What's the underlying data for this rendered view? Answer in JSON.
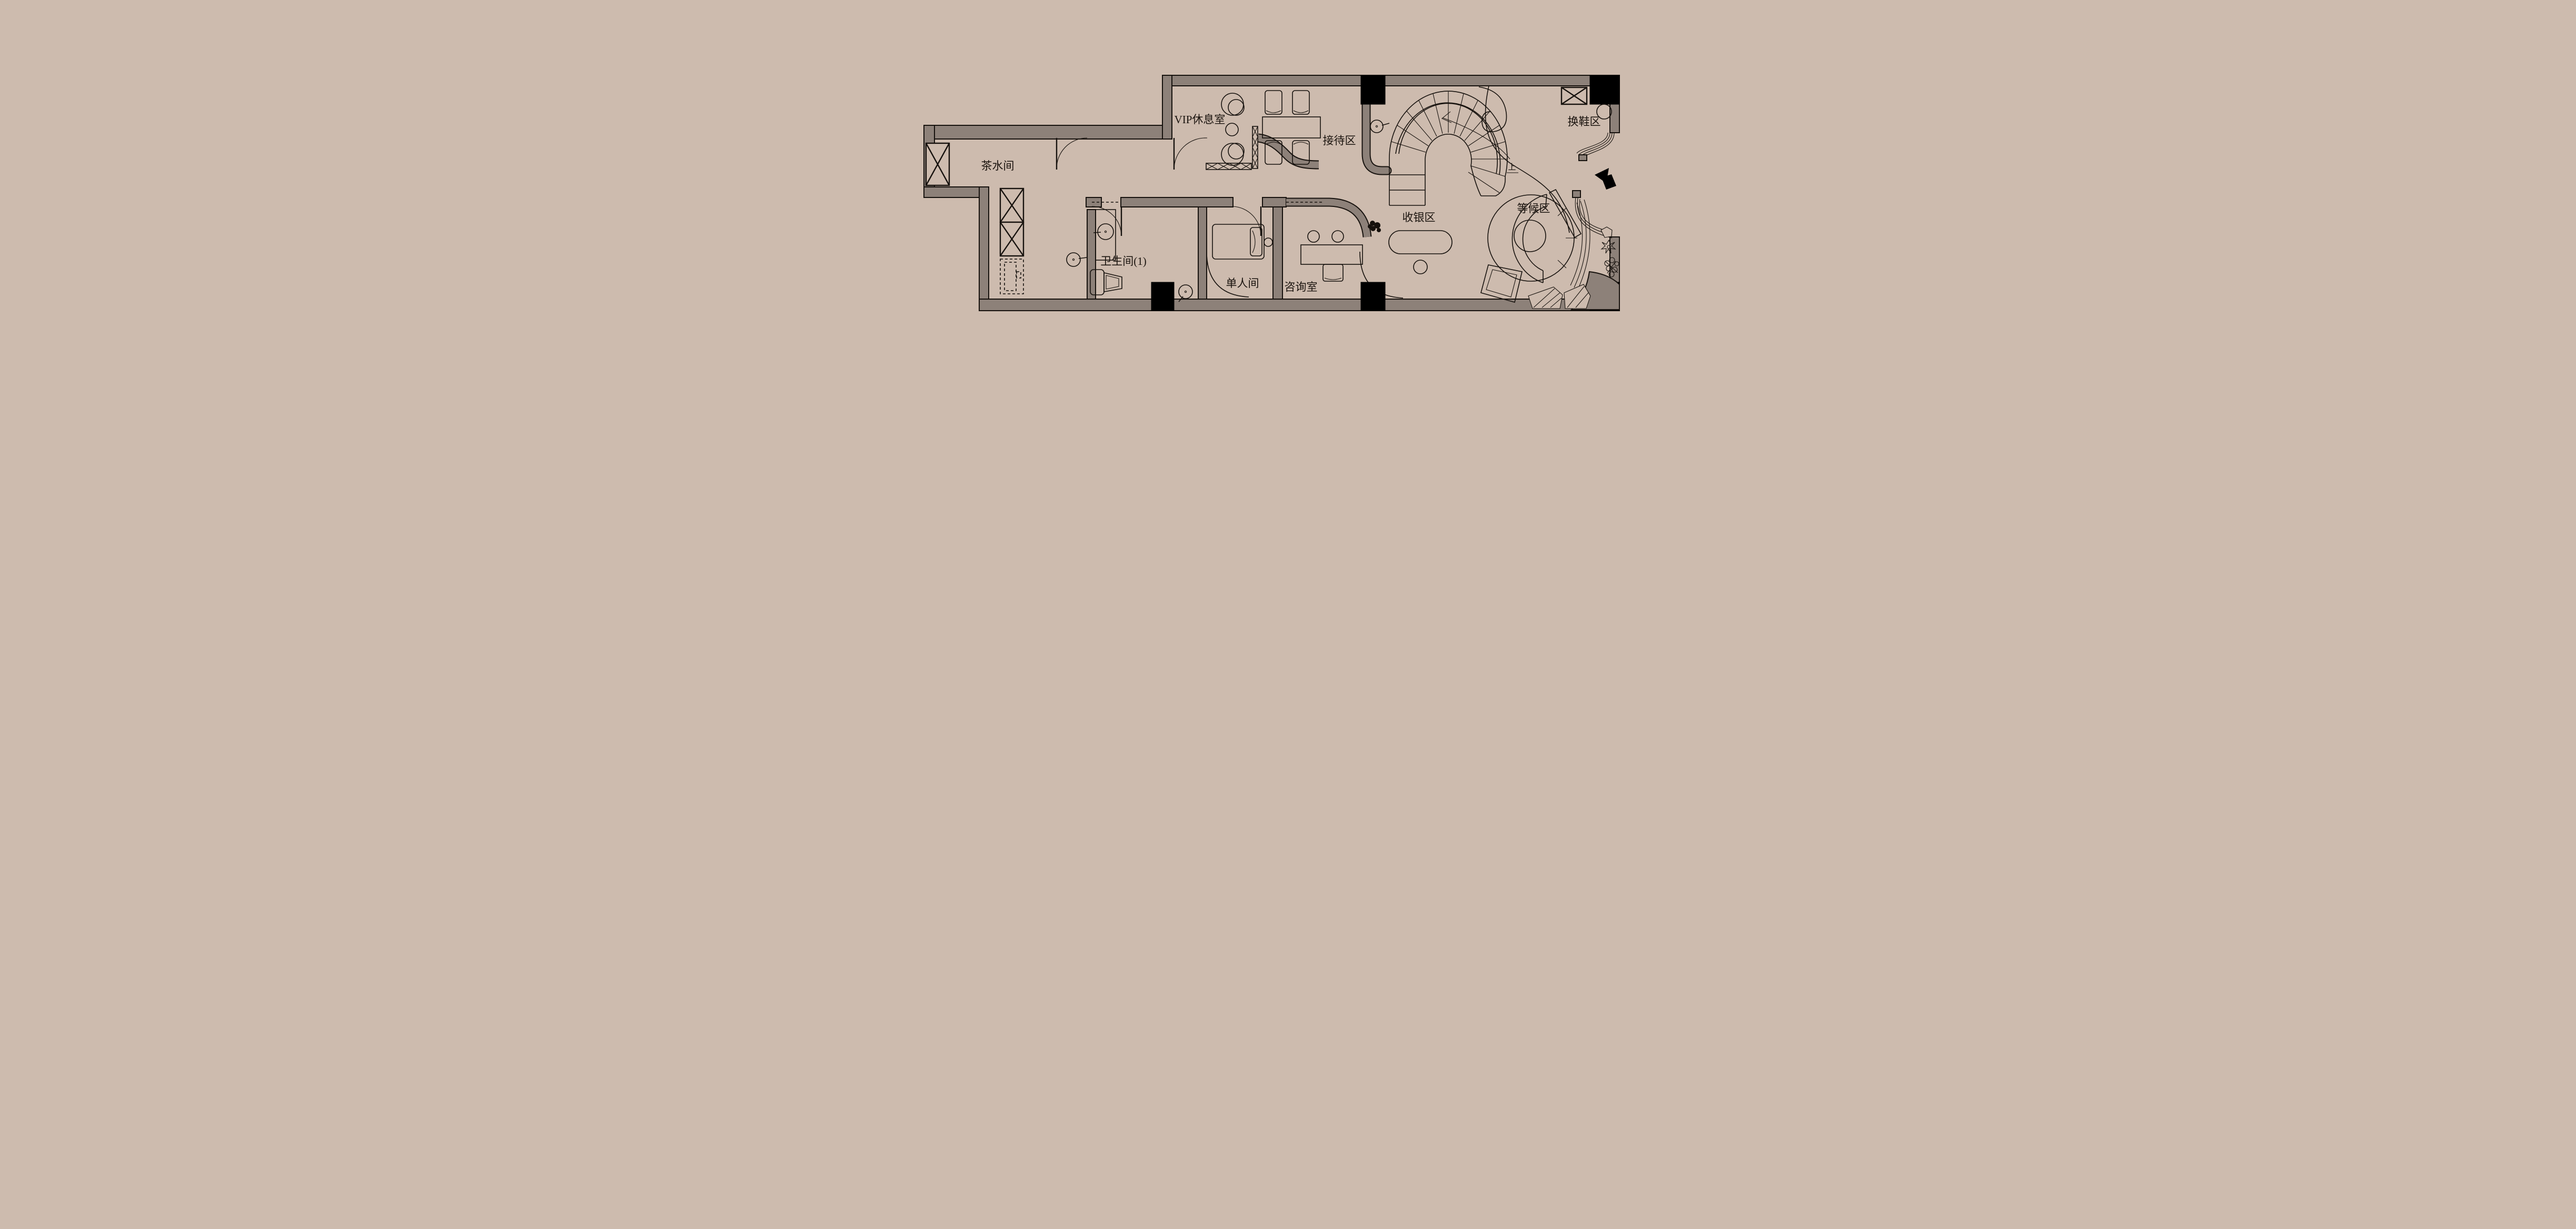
{
  "app": {
    "type": "floor-plan",
    "language": "zh-CN"
  },
  "colors": {
    "background": "#cdbbae",
    "wall": "#8d8179",
    "line": "#17120e",
    "column": "#000000"
  },
  "rooms": [
    {
      "id": "tea-room",
      "label": "茶水间"
    },
    {
      "id": "vip-lounge",
      "label": "VIP休息室"
    },
    {
      "id": "reception",
      "label": "接待区"
    },
    {
      "id": "shoe-change",
      "label": "换鞋区"
    },
    {
      "id": "bathroom-1",
      "label": "卫生间(1)"
    },
    {
      "id": "single-room",
      "label": "单人间"
    },
    {
      "id": "consult-room",
      "label": "咨询室"
    },
    {
      "id": "cashier",
      "label": "收银区"
    },
    {
      "id": "waiting",
      "label": "等候区"
    }
  ],
  "annotations": [
    {
      "id": "stairs-up",
      "label": "上"
    }
  ],
  "icons": {
    "entry_arrow": "entry-direction-arrow",
    "spiral_stairs": "spiral-staircase",
    "window_box": "window-shaft-symbol",
    "plant": "plant-icon"
  }
}
